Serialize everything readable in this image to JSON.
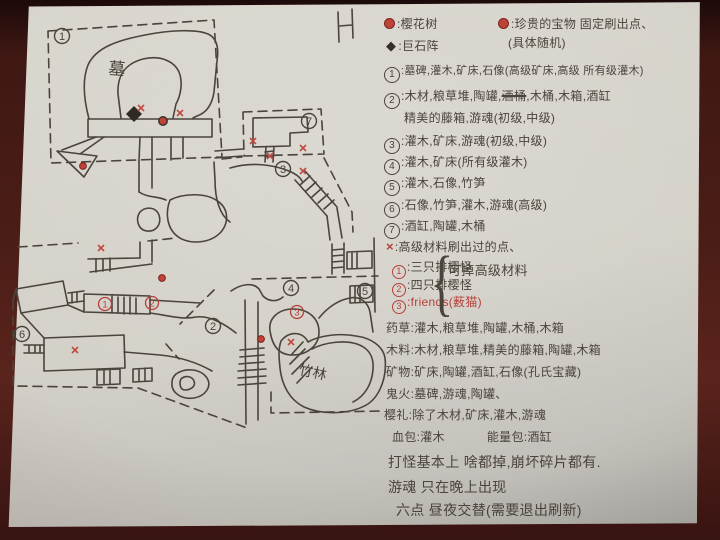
{
  "colors": {
    "ink": "#4a443b",
    "red": "#b5413a",
    "paper": "#d3d0c8",
    "table": "#461b15"
  },
  "legend": {
    "sakura_label": ":樱花树",
    "treasure_label": ":珍贵的宝物 固定刷出点、",
    "treasure_sub": "(具体随机)",
    "henge_symbol": "◆",
    "henge_label": ":巨石阵",
    "x_symbol": "×",
    "regions": [
      {
        "num": "1",
        "text": ":墓碑,灌木,矿床,石像(高级矿床,高级 所有级灌木)"
      },
      {
        "num": "2",
        "text_pre": ":木材,粮草堆,陶罐,",
        "struck": "酒桶",
        "text_post": ",木桶,木箱,酒缸",
        "text2": "精美的藤箱,游魂(初级,中级)"
      },
      {
        "num": "3",
        "text": ":灌木,矿床,游魂(初级,中级)"
      },
      {
        "num": "4",
        "text": ":灌木,矿床(所有级灌木)"
      },
      {
        "num": "5",
        "text": ":灌木,石像,竹笋"
      },
      {
        "num": "6",
        "text": ":石像,竹笋,灌木,游魂(高级)"
      },
      {
        "num": "7",
        "text": ":酒缸,陶罐,木桶"
      }
    ],
    "x_note": ":高级材料刷出过的点、",
    "spawns": [
      {
        "num": "1",
        "text": ":三只排樱怪"
      },
      {
        "num": "2",
        "text": ":四只排樱怪"
      },
      {
        "num": "3",
        "text": ":friends(薮猫)"
      }
    ],
    "spawn_brace": "{",
    "spawn_brace_note": "可掉高级材料",
    "drops": [
      "药草:灌木,粮草堆,陶罐,木桶,木箱",
      "木料:木材,粮草堆,精美的藤箱,陶罐,木箱",
      "矿物:矿床,陶罐,酒缸,石像(孔氏宝藏)",
      "鬼火:墓碑,游魂,陶罐、"
    ],
    "sakura_drop": "樱礼:除了木材,矿床,灌木,游魂",
    "hp_drop": "血包:灌木",
    "energy_drop": "能量包:酒缸",
    "notes": [
      "打怪基本上 啥都掉,崩坏碎片都有.",
      "游魂 只在晚上出现",
      "六点 昼夜交替(需要退出刷新)"
    ]
  },
  "map": {
    "tomb_label": "墓",
    "bamboo_label": "竹林",
    "region_markers": [
      "1",
      "2",
      "3",
      "4",
      "5",
      "6",
      "7"
    ],
    "spawn_markers": [
      "1",
      "2",
      "3"
    ]
  }
}
